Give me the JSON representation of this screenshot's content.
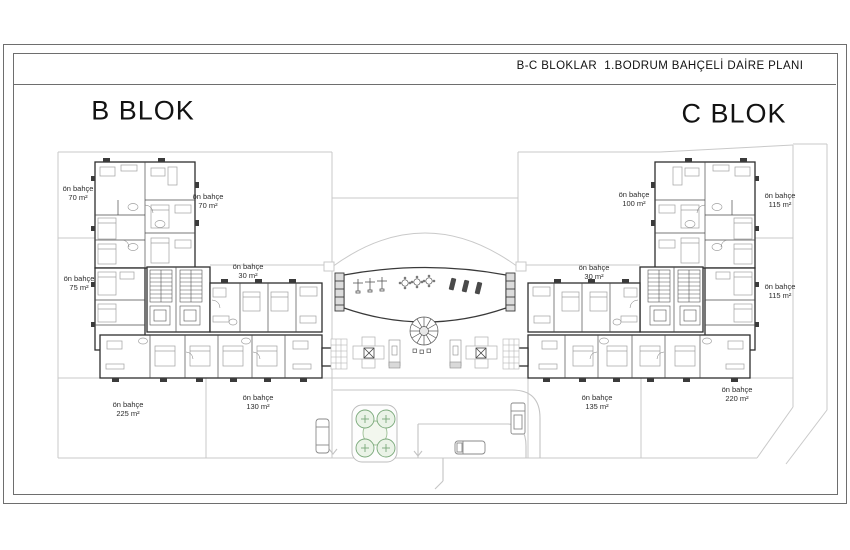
{
  "title_block": {
    "text": "B-C BLOKLAR  1.BODRUM BAHÇELİ DAİRE PLANI"
  },
  "blocks": {
    "left_label": "B BLOK",
    "right_label": "C BLOK"
  },
  "gardens": [
    {
      "name": "ön bahçe",
      "area": "70 m²"
    },
    {
      "name": "ön bahçe",
      "area": "70 m²"
    },
    {
      "name": "ön bahçe",
      "area": "75 m²"
    },
    {
      "name": "ön bahçe",
      "area": "30 m²"
    },
    {
      "name": "ön bahçe",
      "area": "225 m²"
    },
    {
      "name": "ön bahçe",
      "area": "130 m²"
    },
    {
      "name": "ön bahçe",
      "area": "100 m²"
    },
    {
      "name": "ön bahçe",
      "area": "115 m²"
    },
    {
      "name": "ön bahçe",
      "area": "30 m²"
    },
    {
      "name": "ön bahçe",
      "area": "115 m²"
    },
    {
      "name": "ön bahçe",
      "area": "135 m²"
    },
    {
      "name": "ön bahçe",
      "area": "220 m²"
    }
  ],
  "colors": {
    "paper": "#ffffff",
    "frame": "#6e6e6e",
    "wall": "#2e2e2e",
    "inner_wall": "#4a4a4a",
    "furniture": "#a0a0a0",
    "boundary": "#c9c9c9",
    "tree_stroke": "#79a879",
    "tree_fill": "#eaf3e7"
  }
}
